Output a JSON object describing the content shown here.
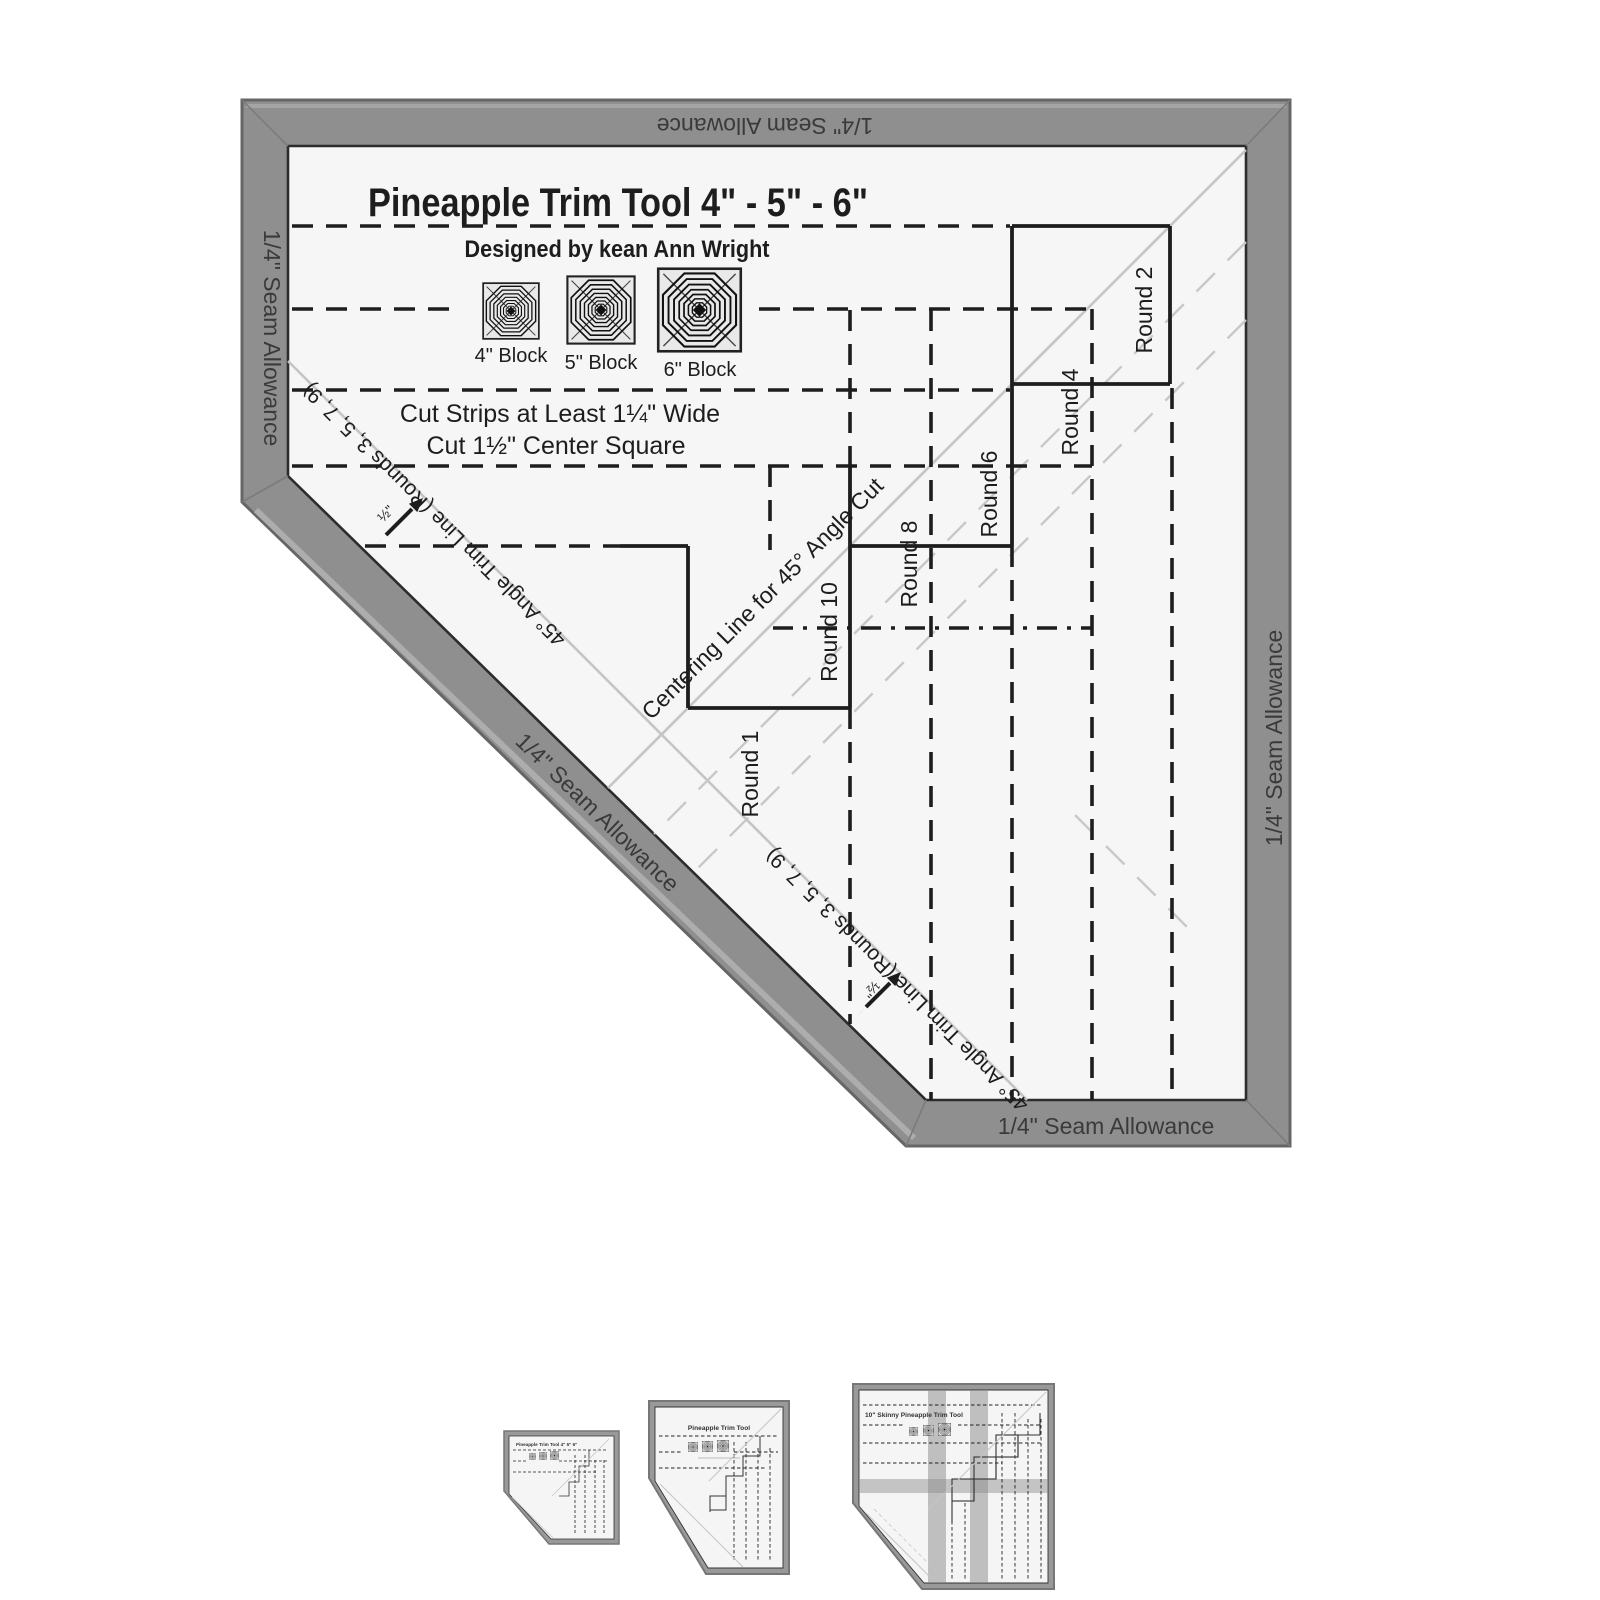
{
  "product": {
    "title": "Pineapple Trim Tool 4\" - 5\" - 6\"",
    "designed_by": "Designed by kean Ann Wright",
    "blocks": [
      {
        "label": "4\" Block"
      },
      {
        "label": "5\" Block"
      },
      {
        "label": "6\" Block"
      }
    ],
    "instructions": {
      "line1": "Cut Strips at Least 1¼\" Wide",
      "line2": "Cut 1½\"  Center Square"
    },
    "seam_allowance": "1/4\" Seam Allowance",
    "rounds": {
      "r1": "Round 1",
      "r2": "Round 2",
      "r4": "Round 4",
      "r6": "Round 6",
      "r8": "Round 8",
      "r10": "Round 10"
    },
    "angle_trim_line": "45° Angle Trim Line (Rounds 3, 5, 7, 9)",
    "centering_line": "Centering Line for 45° Angle Cut",
    "half_inch": "½\"",
    "colors": {
      "frame": "#8f8f8f",
      "frame_edge": "#666666",
      "face": "#f6f6f6",
      "ink": "#1d1d1d",
      "guide_gray": "#c5c5c5",
      "band_text": "#3a3a3a"
    }
  },
  "thumbnails": [
    {
      "label": "Pineapple Trim Tool 4\" 5\" 6\""
    },
    {
      "label": "Pineapple Trim Tool"
    },
    {
      "label": "10\" Skinny Pineapple Trim Tool"
    }
  ]
}
